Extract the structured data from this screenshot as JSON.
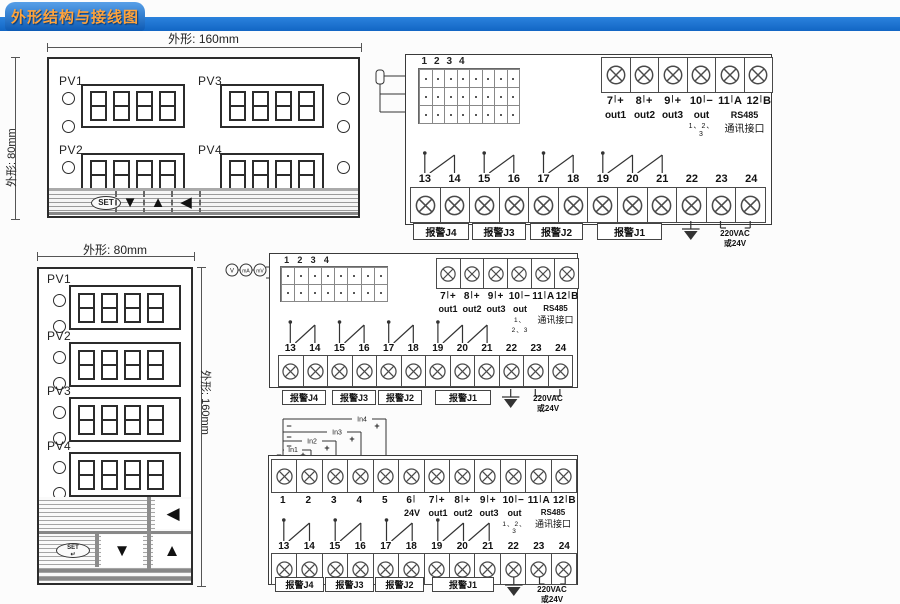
{
  "header": {
    "title": "外形结构与接线图"
  },
  "colors": {
    "accent_blue": "#1b74d4",
    "tab_text": "#ffa33c"
  },
  "panel_h": {
    "dim_top": "外形: 160mm",
    "dim_side": "外形: 80mm",
    "groups": [
      "PV1",
      "PV3",
      "PV2",
      "PV4"
    ],
    "set_label": "SET",
    "btn_down": "▼",
    "btn_up": "▲",
    "btn_left": "◀"
  },
  "panel_v": {
    "dim_top": "外形: 80mm",
    "dim_side": "外形: 160mm",
    "groups": [
      "PV1",
      "PV2",
      "PV3",
      "PV4"
    ],
    "set_label": "SET",
    "set_arrow": "↵",
    "btn_down": "▼",
    "btn_up": "▲",
    "btn_left": "◀"
  },
  "wiring": {
    "input_cols": [
      "1",
      "2",
      "3",
      "4"
    ],
    "out_row": [
      {
        "num": "7",
        "tick": "|",
        "sign": "+"
      },
      {
        "num": "8",
        "tick": "|",
        "sign": "+"
      },
      {
        "num": "9",
        "tick": "|",
        "sign": "+"
      },
      {
        "num": "10",
        "tick": "|",
        "sign": "−"
      },
      {
        "num": "11",
        "tick": "|",
        "sign": "A"
      },
      {
        "num": "12",
        "tick": "|",
        "sign": "B"
      }
    ],
    "out_labels": [
      "out1",
      "out2",
      "out3"
    ],
    "out_group_label": "out",
    "out_group_sub": "1、2、3",
    "rs485_line1": "RS485",
    "rs485_line2": "通讯接口",
    "bottom_nums": [
      "13",
      "14",
      "15",
      "16",
      "17",
      "18",
      "19",
      "20",
      "21",
      "22",
      "23",
      "24"
    ],
    "alarms": [
      "报警J4",
      "报警J3",
      "报警J2",
      "报警J1"
    ],
    "power_line1": "220VAC",
    "power_line2": "或24V"
  },
  "diagram3": {
    "top_row": [
      {
        "num": "1",
        "tick": "",
        "sign": ""
      },
      {
        "num": "2",
        "tick": "",
        "sign": ""
      },
      {
        "num": "3",
        "tick": "",
        "sign": ""
      },
      {
        "num": "4",
        "tick": "",
        "sign": ""
      },
      {
        "num": "5",
        "tick": "",
        "sign": ""
      },
      {
        "num": "6",
        "tick": "|",
        "sign": ""
      },
      {
        "num": "7",
        "tick": "|",
        "sign": "+"
      },
      {
        "num": "8",
        "tick": "|",
        "sign": "+"
      },
      {
        "num": "9",
        "tick": "|",
        "sign": "+"
      },
      {
        "num": "10",
        "tick": "|",
        "sign": "−"
      },
      {
        "num": "11",
        "tick": "|",
        "sign": "A"
      },
      {
        "num": "12",
        "tick": "|",
        "sign": "B"
      }
    ],
    "t6_label": "24V",
    "inputs": [
      {
        "label": "In1"
      },
      {
        "label": "In2"
      },
      {
        "label": "In3"
      },
      {
        "label": "In4"
      }
    ],
    "plus": "+",
    "minus": "−"
  },
  "sensors": {
    "v": "V",
    "ma": "mA",
    "mv": "mV",
    "plus": "+",
    "minus": "−"
  }
}
